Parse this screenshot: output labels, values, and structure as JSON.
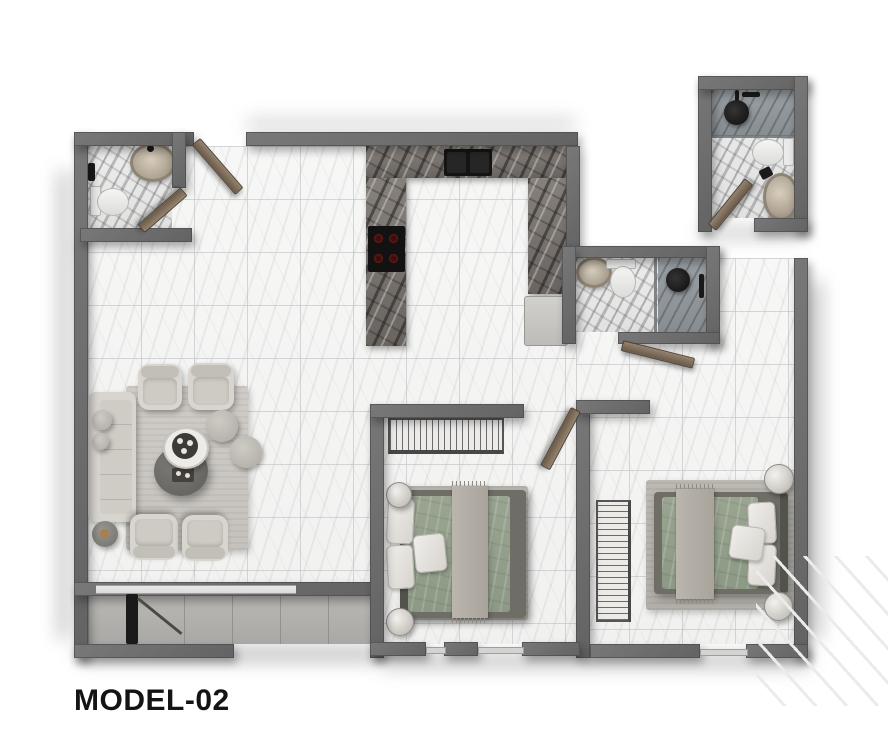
{
  "title": {
    "label": "MODEL-02"
  },
  "floorplan": {
    "model_label": "MODEL-02",
    "rooms": [
      "entry",
      "bathroom-1",
      "kitchen",
      "bathroom-2",
      "bathroom-3",
      "living-dining-room",
      "bedroom-1",
      "bedroom-2",
      "balcony"
    ],
    "fixtures": [
      "vessel-sink",
      "toilet",
      "shower",
      "kitchen-sink",
      "cooktop",
      "fridge",
      "sofa",
      "armchair",
      "coffee-table",
      "tray-table",
      "pouf",
      "side-table",
      "wardrobe",
      "double-bed",
      "nightstand",
      "door-leaf",
      "window"
    ]
  },
  "colors": {
    "wall": "#6e6e6e",
    "floor_tile": "#f4f4f3",
    "dark_marble": "#6f6a65",
    "balcony_tile": "#b4b2af",
    "duvet_green": "#93a08a",
    "wood_door": "#7c6a57",
    "fixture_black": "#141414",
    "text": "#141414"
  }
}
